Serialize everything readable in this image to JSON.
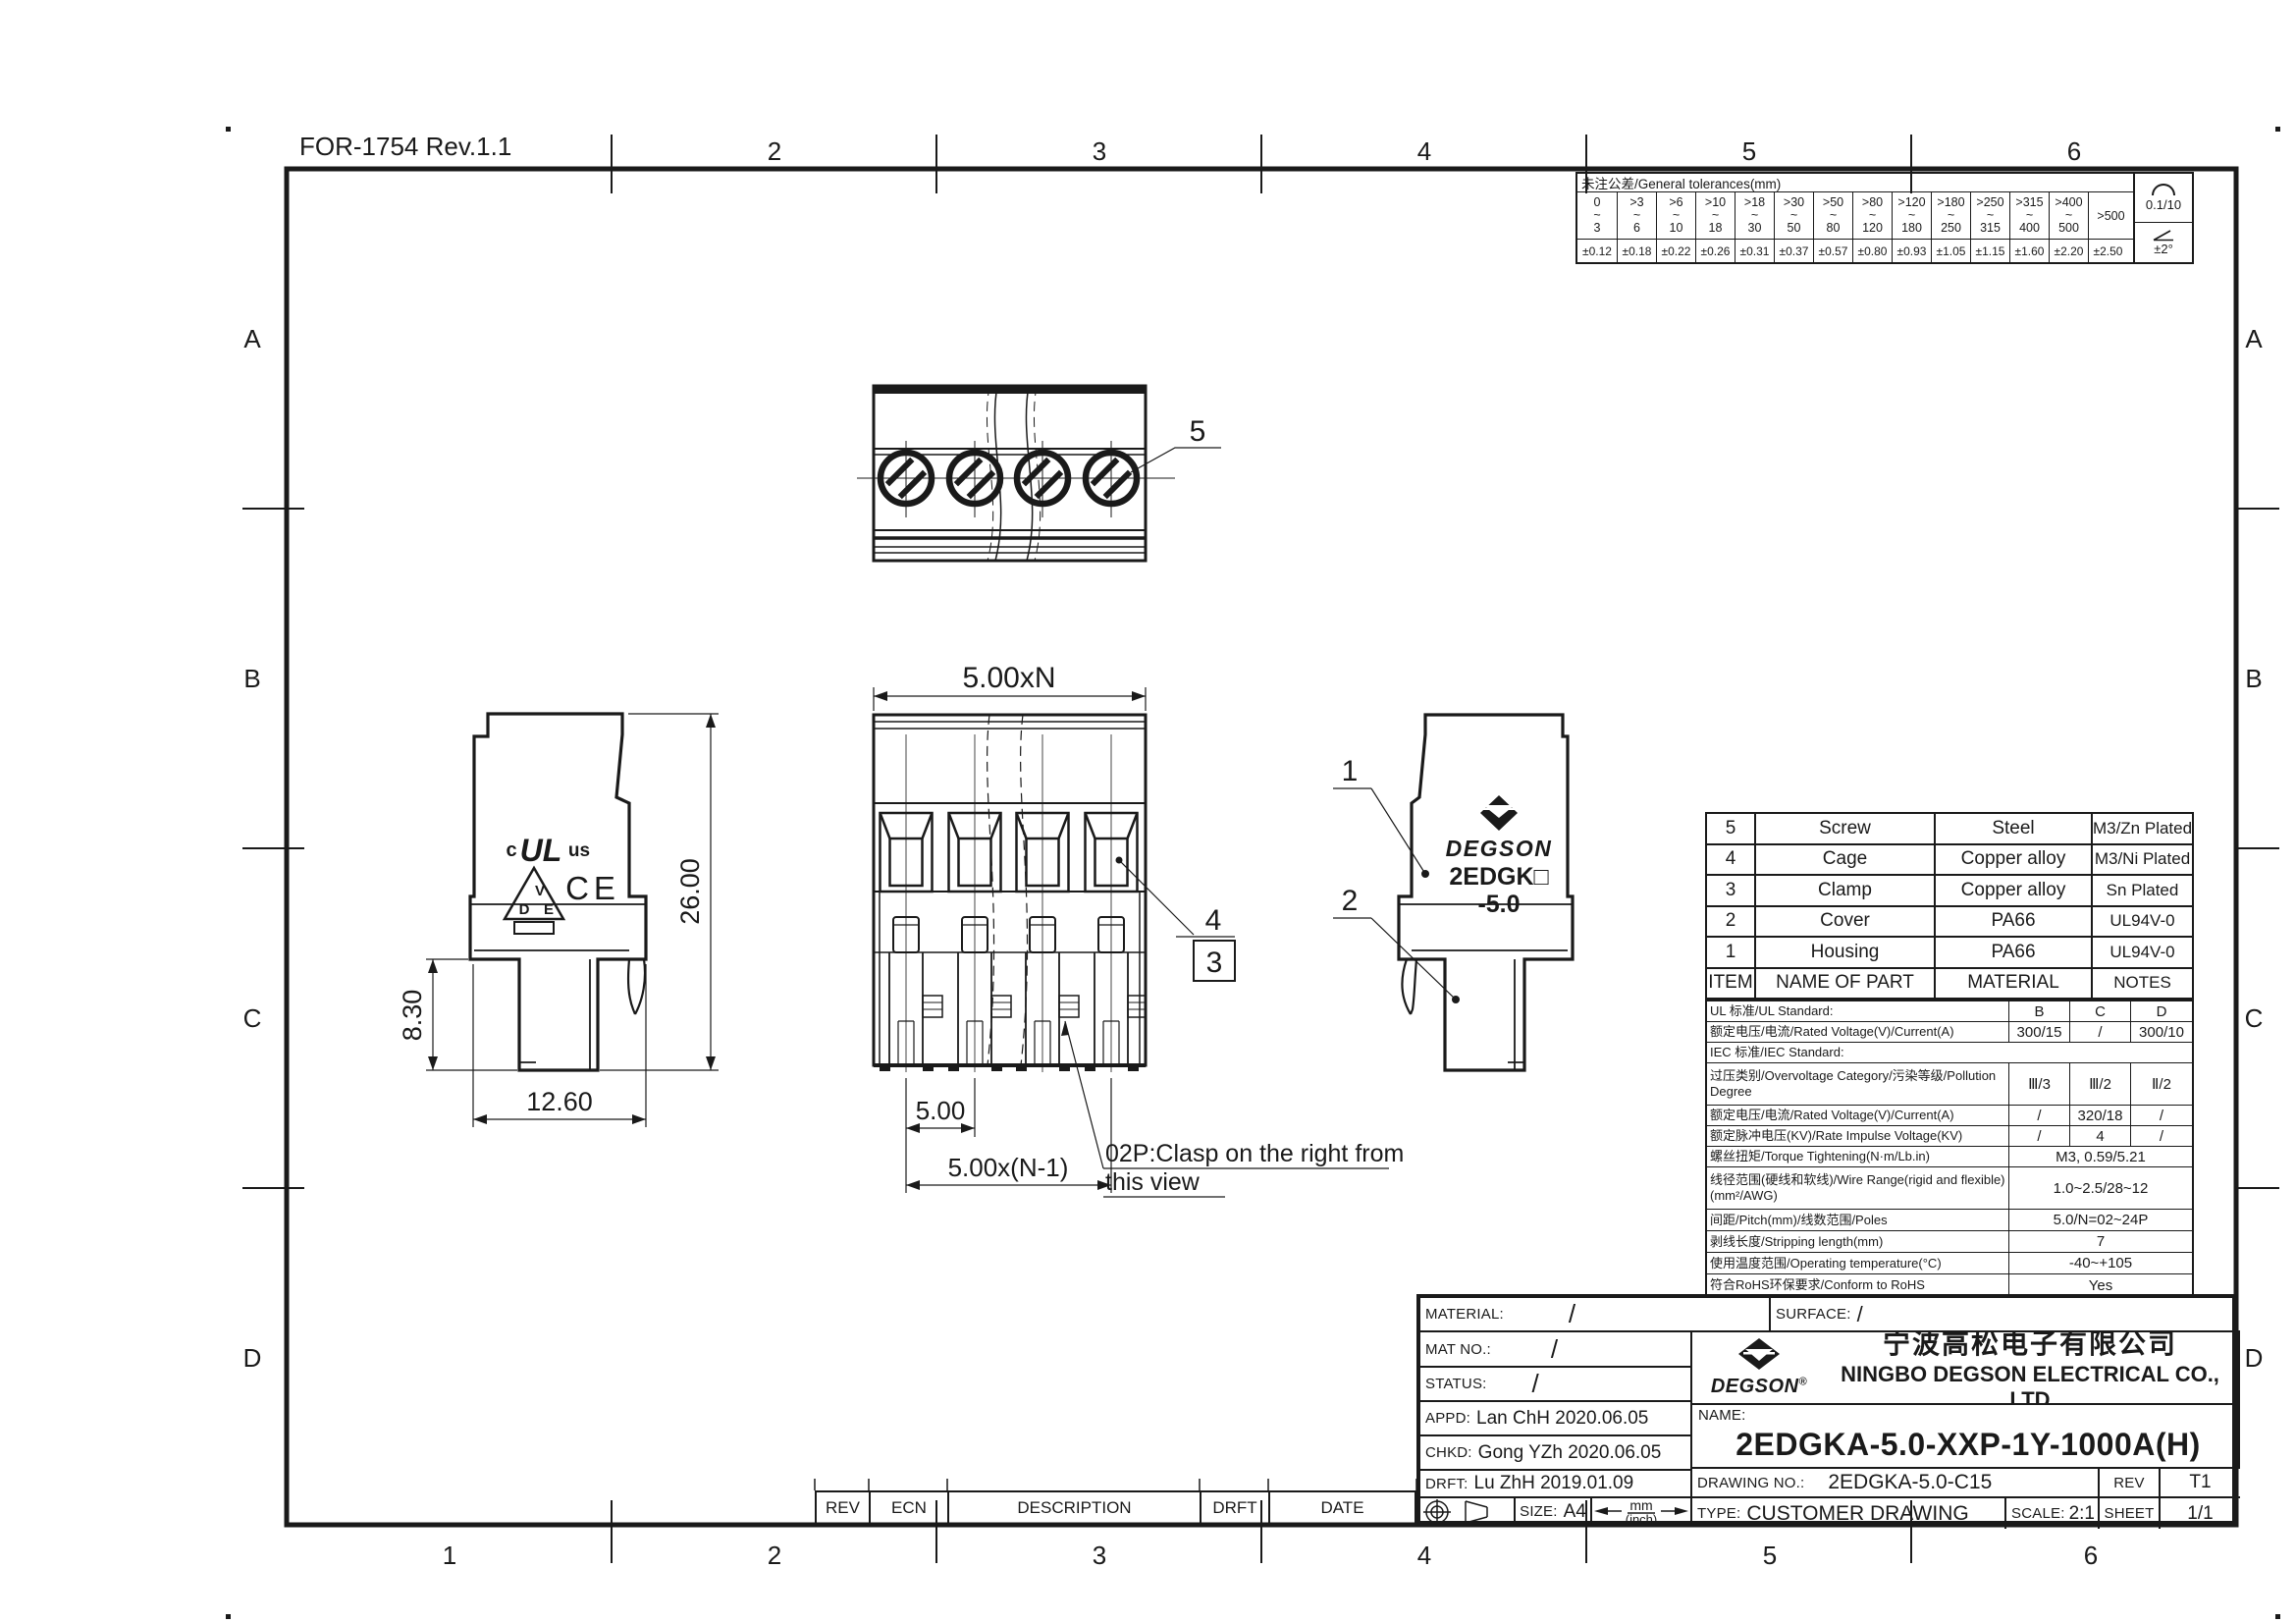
{
  "page": {
    "form_ref": "FOR-1754  Rev.1.1",
    "ink": "#1a1a1a",
    "paper": "#ffffff"
  },
  "grid": {
    "top": [
      "2",
      "3",
      "4",
      "5",
      "6"
    ],
    "bottom": [
      "1",
      "2",
      "3",
      "4",
      "5",
      "6"
    ],
    "left": [
      "A",
      "B",
      "C",
      "D"
    ],
    "right": [
      "A",
      "B",
      "C",
      "D"
    ]
  },
  "tolerance_table": {
    "title": "未注公差/General tolerances(mm)",
    "tilde": "~",
    "ranges": [
      {
        "a": "0",
        "b": "3"
      },
      {
        "a": ">3",
        "b": "6"
      },
      {
        "a": ">6",
        "b": "10"
      },
      {
        "a": ">10",
        "b": "18"
      },
      {
        "a": ">18",
        "b": "30"
      },
      {
        "a": ">30",
        "b": "50"
      },
      {
        "a": ">50",
        "b": "80"
      },
      {
        "a": ">80",
        "b": "120"
      },
      {
        "a": ">120",
        "b": "180"
      },
      {
        "a": ">180",
        "b": "250"
      },
      {
        "a": ">250",
        "b": "315"
      },
      {
        "a": ">315",
        "b": "400"
      },
      {
        "a": ">400",
        "b": "500"
      }
    ],
    "last_range": ">500",
    "values": [
      "±0.12",
      "±0.18",
      "±0.22",
      "±0.26",
      "±0.31",
      "±0.37",
      "±0.57",
      "±0.80",
      "±0.93",
      "±1.05",
      "±1.15",
      "±1.60",
      "±2.20",
      "±2.50"
    ],
    "flatness": "0.1/10",
    "angle": "±2°"
  },
  "parts_table": {
    "header": {
      "item": "ITEM",
      "name": "NAME OF PART",
      "material": "MATERIAL",
      "notes": "NOTES"
    },
    "rows": [
      {
        "item": "5",
        "name": "Screw",
        "material": "Steel",
        "notes": "M3/Zn Plated"
      },
      {
        "item": "4",
        "name": "Cage",
        "material": "Copper alloy",
        "notes": "M3/Ni Plated"
      },
      {
        "item": "3",
        "name": "Clamp",
        "material": "Copper alloy",
        "notes": "Sn Plated"
      },
      {
        "item": "2",
        "name": "Cover",
        "material": "PA66",
        "notes": "UL94V-0"
      },
      {
        "item": "1",
        "name": "Housing",
        "material": "PA66",
        "notes": "UL94V-0"
      }
    ]
  },
  "specs_table": {
    "rows": [
      {
        "label": "UL 标准/UL Standard:",
        "b": "B",
        "c": "C",
        "d": "D"
      },
      {
        "label": "额定电压/电流/Rated Voltage(V)/Current(A)",
        "b": "300/15",
        "c": "/",
        "d": "300/10"
      },
      {
        "label": "IEC 标准/IEC Standard:"
      },
      {
        "label": "过压类别/Overvoltage Category/污染等级/Pollution Degree",
        "b": "Ⅲ/3",
        "c": "Ⅲ/2",
        "d": "Ⅱ/2"
      },
      {
        "label": "额定电压/电流/Rated Voltage(V)/Current(A)",
        "b": "/",
        "c": "320/18",
        "d": "/"
      },
      {
        "label": "额定脉冲电压(KV)/Rate Impulse Voltage(KV)",
        "b": "/",
        "c": "4",
        "d": "/"
      },
      {
        "label": "螺丝扭矩/Torque Tightening(N·m/Lb.in)",
        "merged": "M3, 0.59/5.21"
      },
      {
        "label": "线径范围(硬线和软线)/Wire Range(rigid and flexible)(mm²/AWG)",
        "merged": "1.0~2.5/28~12"
      },
      {
        "label": "间距/Pitch(mm)/线数范围/Poles",
        "merged": "5.0/N=02~24P"
      },
      {
        "label": "剥线长度/Stripping length(mm)",
        "merged": "7"
      },
      {
        "label": "使用温度范围/Operating temperature(°C)",
        "merged": "-40~+105"
      },
      {
        "label": "符合RoHS环保要求/Conform to RoHS",
        "merged": "Yes"
      }
    ]
  },
  "title_block": {
    "material_label": "MATERIAL:",
    "material_value": "/",
    "surface_label": "SURFACE:",
    "surface_value": "/",
    "mat_no_label": "MAT NO.:",
    "mat_no_value": "/",
    "status_label": "STATUS:",
    "status_value": "/",
    "appd_label": "APPD:",
    "appd_value": "Lan ChH 2020.06.05",
    "chkd_label": "CHKD:",
    "chkd_value": "Gong YZh 2020.06.05",
    "drft_label": "DRFT:",
    "drft_value": "Lu ZhH 2019.01.09",
    "size_label": "SIZE:",
    "size_value": "A4",
    "units_top": "mm",
    "units_bottom": "(inch)",
    "brand": "DEGSON",
    "brand_reg": "®",
    "company_cn": "宁波高松电子有限公司",
    "company_en": "NINGBO DEGSON ELECTRICAL CO., LTD",
    "name_label": "NAME:",
    "name_value": "2EDGKA-5.0-XXP-1Y-1000A(H)",
    "drawing_no_label": "DRAWING NO.:",
    "drawing_no_value": "2EDGKA-5.0-C15",
    "rev_label": "REV",
    "rev_value": "T1",
    "type_label": "TYPE:",
    "type_value": "CUSTOMER DRAWING",
    "scale_label": "SCALE:",
    "scale_value": "2:1",
    "sheet_label": "SHEET",
    "sheet_value": "1/1"
  },
  "revision_strip": {
    "h1": "REV",
    "h2": "ECN",
    "h3": "DESCRIPTION",
    "h4": "DRFT",
    "h5": "DATE"
  },
  "views": {
    "top": {
      "callout_screw": "5"
    },
    "front": {
      "dim_total": "5.00xN",
      "dim_pitch": "5.00",
      "dim_span": "5.00x(N-1)",
      "callout_cage": "4",
      "callout_clamp": "3",
      "note_line1": "02P:Clasp on the right from",
      "note_line2": "this view"
    },
    "left": {
      "dim_height": "26.00",
      "dim_foot": "8.30",
      "dim_width": "12.60",
      "ul_c": "c",
      "ul_mark": "UL",
      "ul_us": "us",
      "vde_v": "V",
      "vde_d": "D",
      "vde_e": "E",
      "ce_mark": "CE"
    },
    "right": {
      "callout_housing": "1",
      "callout_cover": "2",
      "brand": "DEGSON",
      "model": "2EDGK□",
      "pitch_suffix": "-5.0"
    }
  }
}
